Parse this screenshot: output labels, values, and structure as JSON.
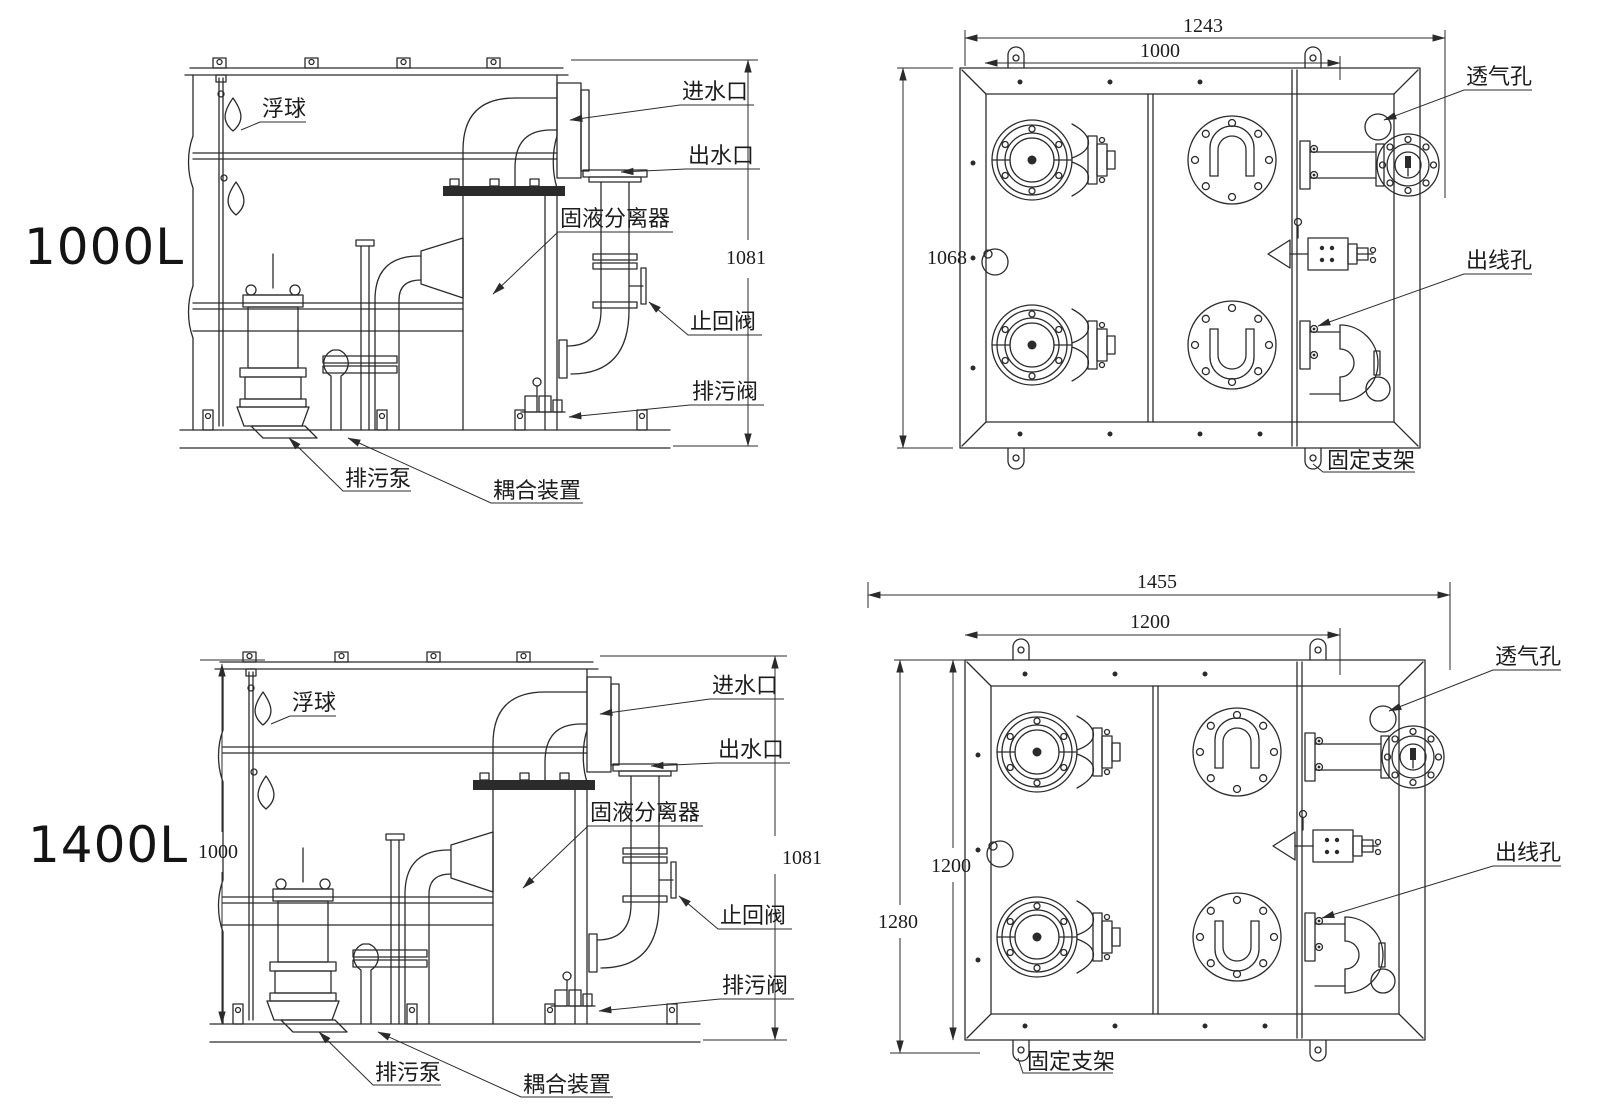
{
  "canvas": {
    "background": "#ffffff",
    "line_color": "#2b2b2b"
  },
  "views": {
    "side_1000": {
      "model": "1000L",
      "labels": {
        "float_ball": "浮球",
        "inlet": "进水口",
        "outlet": "出水口",
        "separator": "固液分离器",
        "check_valve": "止回阀",
        "drain_valve": "排污阀",
        "sewage_pump": "排污泵",
        "coupling": "耦合装置"
      },
      "dims": {
        "height": "1081"
      }
    },
    "top_1000": {
      "labels": {
        "vent_hole": "透气孔",
        "wire_hole": "出线孔",
        "bracket": "固定支架"
      },
      "dims": {
        "outer_width": "1243",
        "inner_width": "1000",
        "height": "1068"
      }
    },
    "side_1400": {
      "model": "1400L",
      "labels": {
        "float_ball": "浮球",
        "inlet": "进水口",
        "outlet": "出水口",
        "separator": "固液分离器",
        "check_valve": "止回阀",
        "drain_valve": "排污阀",
        "sewage_pump": "排污泵",
        "coupling": "耦合装置"
      },
      "dims": {
        "height_left": "1000",
        "height_right": "1081"
      }
    },
    "top_1400": {
      "labels": {
        "vent_hole": "透气孔",
        "wire_hole": "出线孔",
        "bracket": "固定支架"
      },
      "dims": {
        "outer_width": "1455",
        "inner_width": "1200",
        "inner_height": "1200",
        "outer_height": "1280"
      }
    }
  }
}
